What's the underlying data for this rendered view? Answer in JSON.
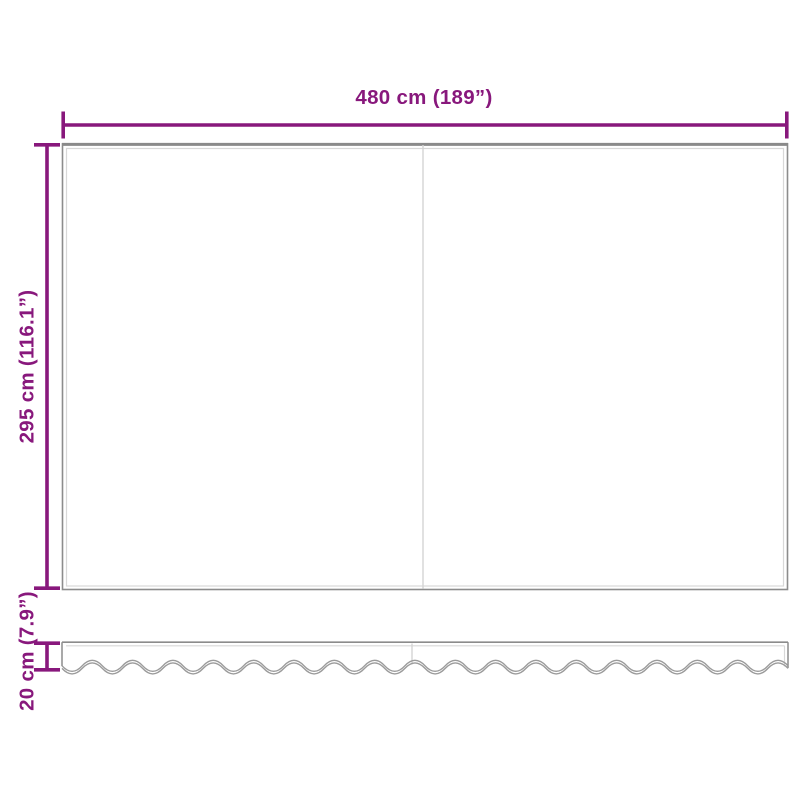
{
  "diagram": {
    "labels": {
      "width": "480 cm (189”)",
      "height": "295 cm (116.1”)",
      "valance_height": "20 cm (7.9”)"
    },
    "colors": {
      "dimension": "#88187C",
      "outline": "#8C8C8C",
      "seam": "#D8D8D8",
      "divider": "#D4D4D4",
      "wave": "#9B9B9B",
      "background": "#FFFFFF"
    }
  }
}
